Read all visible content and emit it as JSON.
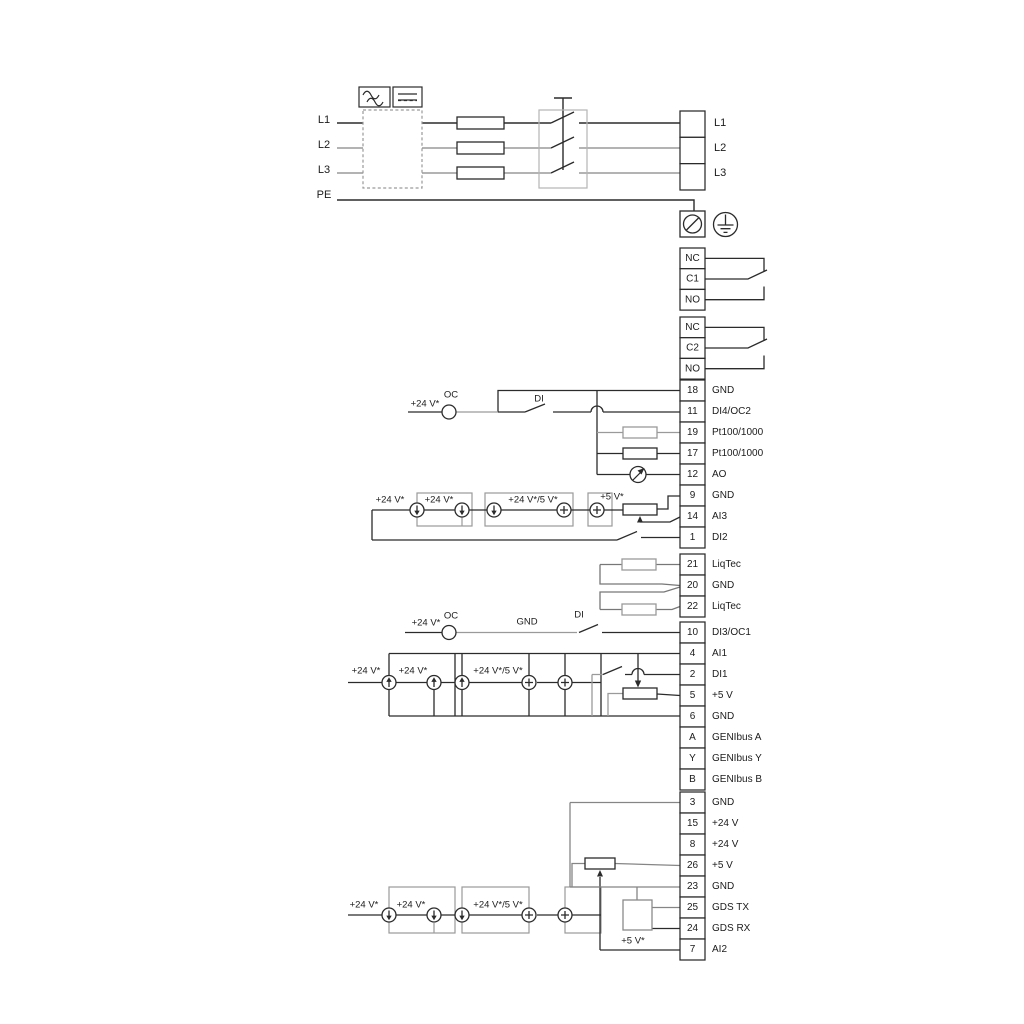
{
  "power": {
    "inputs": [
      "L1",
      "L2",
      "L3",
      "PE"
    ],
    "outputs": [
      "L1",
      "L2",
      "L3"
    ]
  },
  "relays": [
    {
      "cells": [
        "NC",
        "C1",
        "NO"
      ]
    },
    {
      "cells": [
        "NC",
        "C2",
        "NO"
      ]
    }
  ],
  "terminal_blocks": {
    "upper": [
      {
        "id": "18",
        "label": "GND"
      },
      {
        "id": "11",
        "label": "DI4/OC2"
      },
      {
        "id": "19",
        "label": "Pt100/1000"
      },
      {
        "id": "17",
        "label": "Pt100/1000"
      },
      {
        "id": "12",
        "label": "AO"
      },
      {
        "id": "9",
        "label": "GND"
      },
      {
        "id": "14",
        "label": "AI3"
      },
      {
        "id": "1",
        "label": "DI2"
      }
    ],
    "liqtec": [
      {
        "id": "21",
        "label": "LiqTec"
      },
      {
        "id": "20",
        "label": "GND"
      },
      {
        "id": "22",
        "label": "LiqTec"
      }
    ],
    "mid": [
      {
        "id": "10",
        "label": "DI3/OC1"
      },
      {
        "id": "4",
        "label": "AI1"
      },
      {
        "id": "2",
        "label": "DI1"
      },
      {
        "id": "5",
        "label": "+5 V"
      },
      {
        "id": "6",
        "label": "GND"
      },
      {
        "id": "A",
        "label": "GENIbus A"
      },
      {
        "id": "Y",
        "label": "GENIbus Y"
      },
      {
        "id": "B",
        "label": "GENIbus B"
      }
    ],
    "bottom": [
      {
        "id": "3",
        "label": "GND"
      },
      {
        "id": "15",
        "label": "+24 V"
      },
      {
        "id": "8",
        "label": "+24 V"
      },
      {
        "id": "26",
        "label": "+5 V"
      },
      {
        "id": "23",
        "label": "GND"
      },
      {
        "id": "25",
        "label": "GDS TX"
      },
      {
        "id": "24",
        "label": "GDS RX"
      },
      {
        "id": "7",
        "label": "AI2"
      }
    ]
  },
  "labels": {
    "plus24": "+24 V*",
    "plus24or5": "+24 V*/5 V*",
    "plus5": "+5 V*",
    "oc": "OC",
    "di": "DI",
    "gnd": "GND"
  },
  "colors": {
    "wire": "#2b2b2b",
    "alt_wire": "#9a9a9a",
    "loop_wire": "#777777",
    "text": "#1b1b1b",
    "background": "#ffffff"
  }
}
